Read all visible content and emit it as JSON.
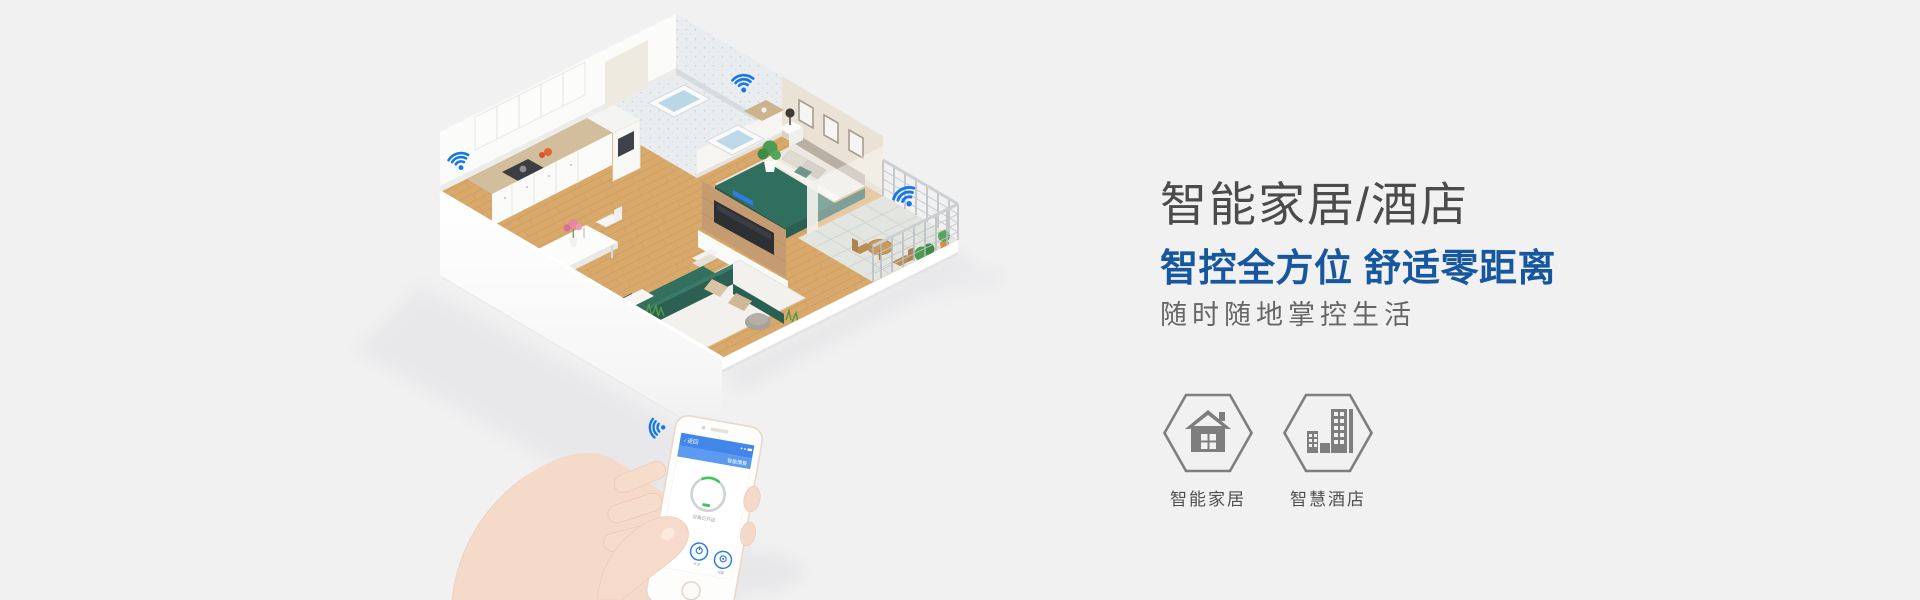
{
  "hero": {
    "title": "智能家居/酒店",
    "subtitle": "智控全方位 舒适零距离",
    "description": "随时随地掌控生活",
    "title_color": "#4b4b4b",
    "subtitle_color": "#17579e",
    "description_color": "#666666"
  },
  "categories": [
    {
      "id": "smart-home",
      "label": "智能家居",
      "icon": "home-icon"
    },
    {
      "id": "smart-hotel",
      "label": "智慧酒店",
      "icon": "hotel-building-icon"
    }
  ],
  "illustration": {
    "wifi_color": "#1677e8",
    "wifi_icon_count": 4,
    "colors": {
      "background": "#f1f1f2",
      "wood_floor": "#d8a96b",
      "teal_furniture": "#2f6e60",
      "wall_white": "#fcfcfc",
      "bedroom_wall_beige": "#eae2d4",
      "bathroom_tile": "#e9edef",
      "icon_gray": "#7e7e7e"
    },
    "phone_screen": {
      "back_label": "返回",
      "header_title": "智能情景",
      "dial_status": "设备已开启",
      "buttons": [
        {
          "label": "情景"
        },
        {
          "label": "开关"
        },
        {
          "label": "设置"
        }
      ]
    }
  }
}
